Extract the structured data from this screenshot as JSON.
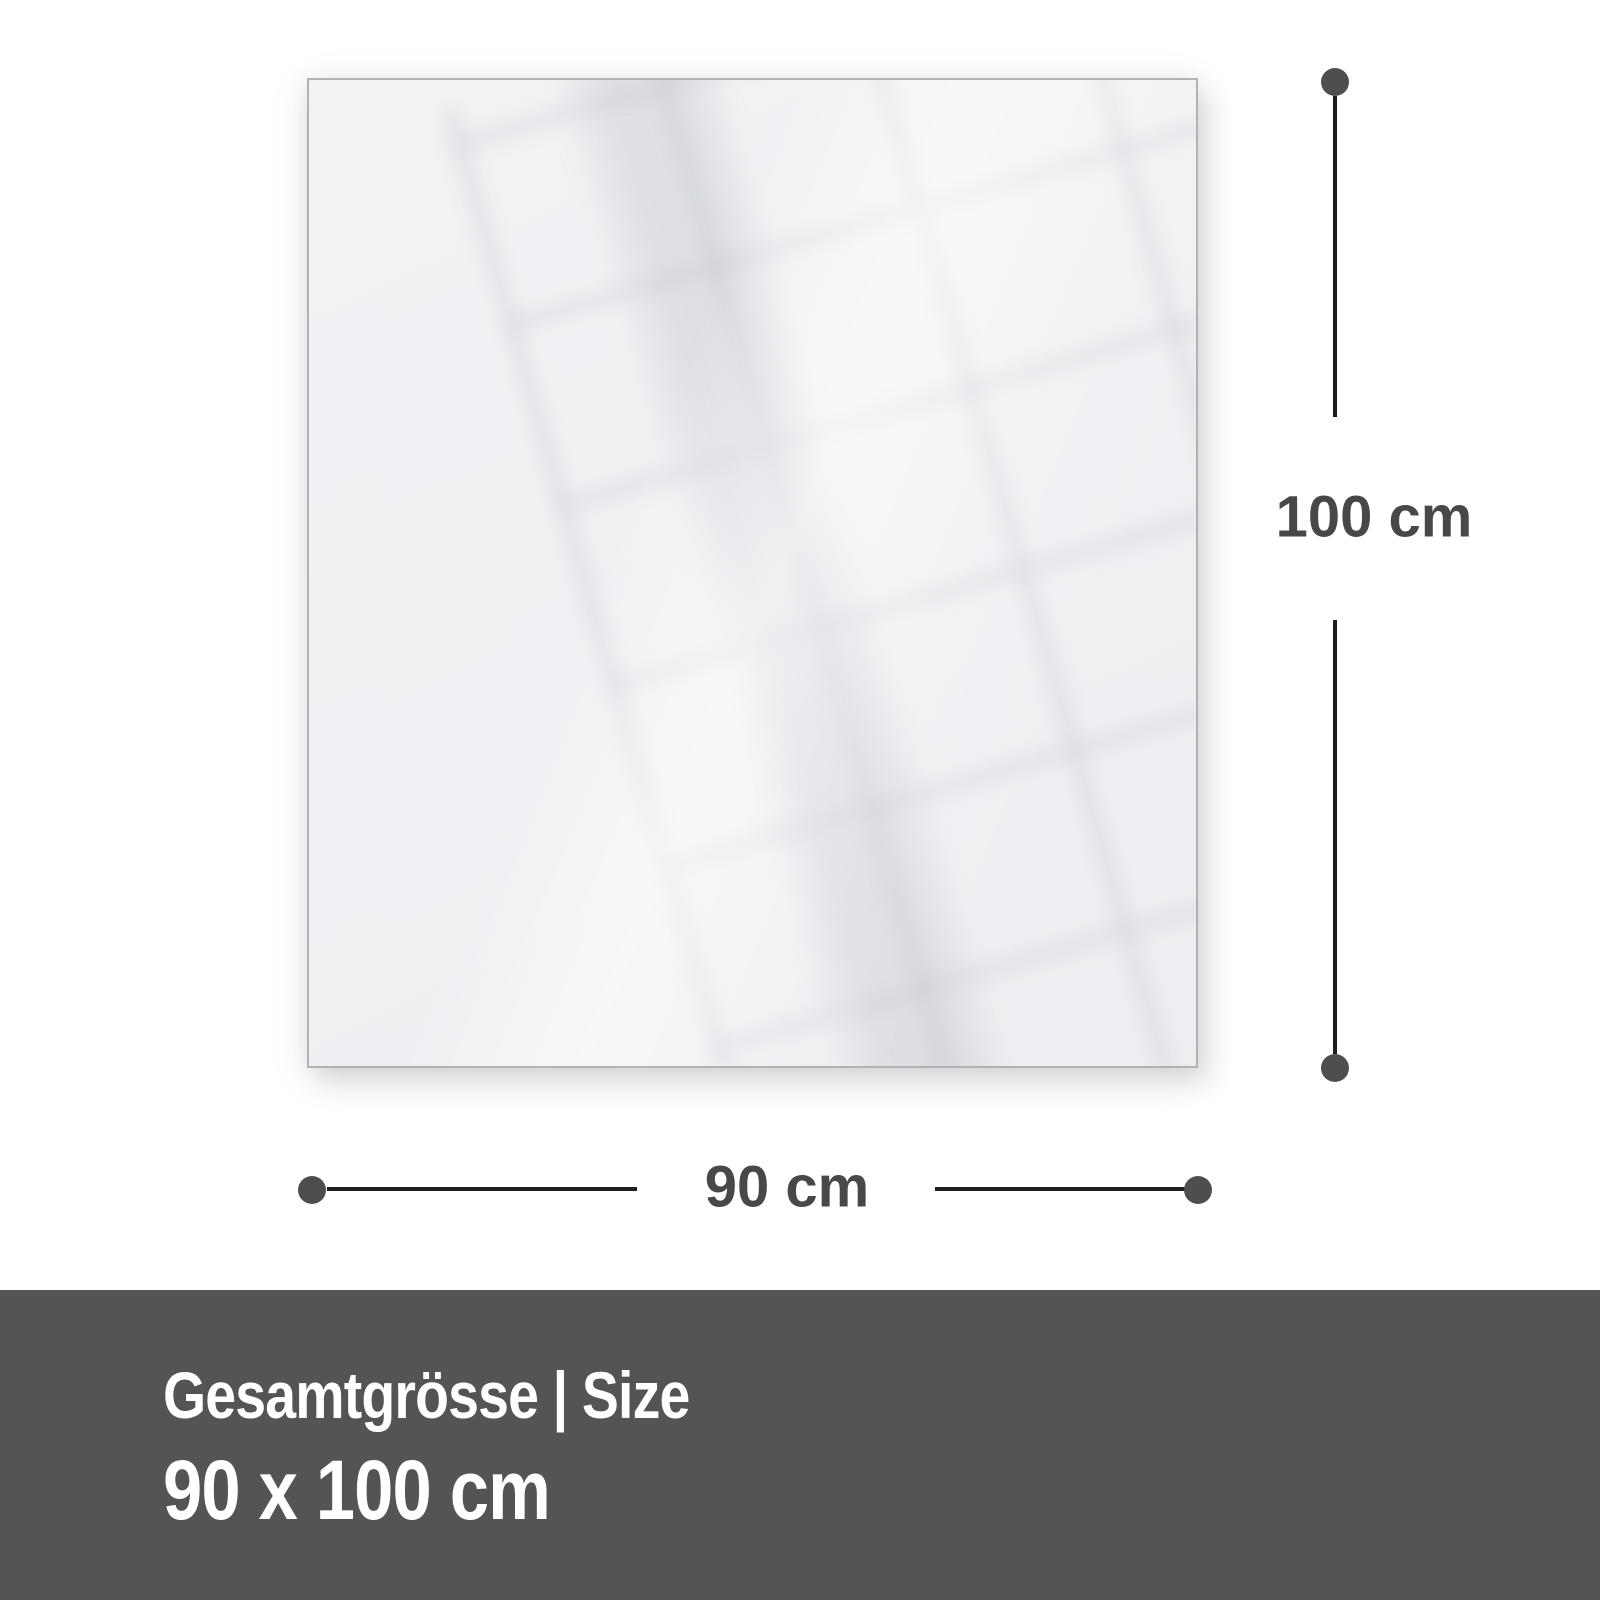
{
  "diagram": {
    "height_label": "100 cm",
    "width_label": "90 cm"
  },
  "footer": {
    "title": "Gesamtgrösse | Size",
    "size_value": "90 x 100 cm"
  },
  "colors": {
    "page-bg": "#ffffff",
    "panel-fill": "#f1f2f4",
    "panel-border": "#b2b2b4",
    "dim-line": "#1e1e22",
    "dim-dot": "#4e4e50",
    "dim-text": "#48484a",
    "footer-bg": "#545456",
    "footer-text": "#ffffff"
  }
}
